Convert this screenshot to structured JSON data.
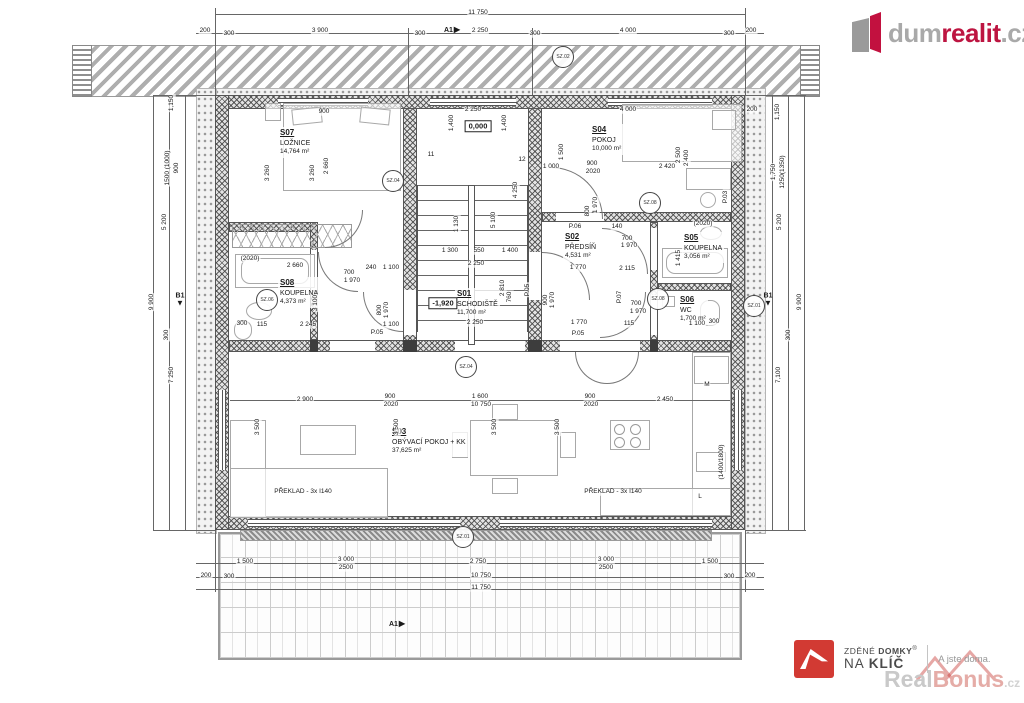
{
  "logo": {
    "gray": "dum",
    "red": "realit",
    "tld": ".cz"
  },
  "footer": {
    "brand_top": "ZDĚNÉ",
    "brand_top_b": "DOMKY",
    "reg": "®",
    "brand_bot": "NA",
    "brand_bot_b": "KLÍČ",
    "tagline": "A jste doma.",
    "wm_gray": "Real",
    "wm_red": "Bonus",
    "wm_tld": ".cz"
  },
  "rooms": {
    "s07": {
      "id": "S07",
      "name": "LOŽNICE",
      "area": "14,764 m²"
    },
    "s04": {
      "id": "S04",
      "name": "POKOJ",
      "area": "10,000 m²"
    },
    "s02": {
      "id": "S02",
      "name": "PŘEDSÍŇ",
      "area": "4,531 m²"
    },
    "s05": {
      "id": "S05",
      "name": "KOUPELNA",
      "area": "3,056 m²"
    },
    "s06": {
      "id": "S06",
      "name": "WC",
      "area": "1,700 m²"
    },
    "s08": {
      "id": "S08",
      "name": "KOUPELNA",
      "area": "4,373 m²"
    },
    "s01": {
      "id": "S01",
      "name": "SCHODIŠTĚ",
      "area": "11,700 m²"
    },
    "s03": {
      "id": "S03",
      "name": "OBÝVACÍ POKOJ + KK",
      "area": "37,625 m²"
    }
  },
  "circle_markers": [
    {
      "label": "SZ.02",
      "x": 563,
      "y": 57
    },
    {
      "label": "SZ.04",
      "x": 393,
      "y": 181
    },
    {
      "label": "SZ.08",
      "x": 650,
      "y": 203
    },
    {
      "label": "SZ.06",
      "x": 267,
      "y": 300
    },
    {
      "label": "SZ.08",
      "x": 658,
      "y": 299
    },
    {
      "label": "SZ.04",
      "x": 466,
      "y": 367
    },
    {
      "label": "SZ.01",
      "x": 463,
      "y": 537
    },
    {
      "label": "SZ.01",
      "x": 754,
      "y": 306
    }
  ],
  "flag_markers": [
    {
      "label": "A1",
      "x": 452,
      "y": 30,
      "dir": "right"
    },
    {
      "label": "A1",
      "x": 397,
      "y": 624,
      "dir": "right"
    },
    {
      "label": "B1",
      "x": 180,
      "y": 300,
      "dir": "down"
    },
    {
      "label": "B1",
      "x": 768,
      "y": 300,
      "dir": "down"
    }
  ],
  "annotations": [
    {
      "t": "11 750",
      "x": 478,
      "y": 13
    },
    {
      "t": "200",
      "x": 205,
      "y": 31
    },
    {
      "t": "300",
      "x": 229,
      "y": 34
    },
    {
      "t": "3 900",
      "x": 320,
      "y": 31
    },
    {
      "t": "300",
      "x": 420,
      "y": 34
    },
    {
      "t": "2 250",
      "x": 480,
      "y": 31
    },
    {
      "t": "300",
      "x": 535,
      "y": 34
    },
    {
      "t": "4 000",
      "x": 628,
      "y": 31
    },
    {
      "t": "300",
      "x": 729,
      "y": 34
    },
    {
      "t": "200",
      "x": 751,
      "y": 31
    },
    {
      "t": "1 500",
      "x": 245,
      "y": 562
    },
    {
      "t": "3 000",
      "x": 346,
      "y": 560
    },
    {
      "t": "2500",
      "x": 346,
      "y": 568
    },
    {
      "t": "2 750",
      "x": 478,
      "y": 562
    },
    {
      "t": "3 000",
      "x": 606,
      "y": 560
    },
    {
      "t": "2500",
      "x": 606,
      "y": 568
    },
    {
      "t": "1 500",
      "x": 710,
      "y": 562
    },
    {
      "t": "200",
      "x": 206,
      "y": 576
    },
    {
      "t": "300",
      "x": 229,
      "y": 577
    },
    {
      "t": "300",
      "x": 729,
      "y": 577
    },
    {
      "t": "200",
      "x": 750,
      "y": 576
    },
    {
      "t": "10 750",
      "x": 481,
      "y": 576
    },
    {
      "t": "11 750",
      "x": 481,
      "y": 588
    },
    {
      "t": "1,150",
      "x": 172,
      "y": 103,
      "r": 1
    },
    {
      "t": "1500 (1000)",
      "x": 168,
      "y": 168,
      "r": 1
    },
    {
      "t": "900",
      "x": 177,
      "y": 168,
      "r": 1
    },
    {
      "t": "5 200",
      "x": 165,
      "y": 222,
      "r": 1
    },
    {
      "t": "9 900",
      "x": 152,
      "y": 302,
      "r": 1
    },
    {
      "t": "300",
      "x": 167,
      "y": 335,
      "r": 1
    },
    {
      "t": "7 250",
      "x": 172,
      "y": 375,
      "r": 1
    },
    {
      "t": "200",
      "x": 752,
      "y": 110
    },
    {
      "t": "1,150",
      "x": 778,
      "y": 112,
      "r": 1
    },
    {
      "t": "1,750",
      "x": 774,
      "y": 172,
      "r": 1
    },
    {
      "t": "1250(1350)",
      "x": 783,
      "y": 172,
      "r": 1
    },
    {
      "t": "5 200",
      "x": 780,
      "y": 222,
      "r": 1
    },
    {
      "t": "9 900",
      "x": 800,
      "y": 302,
      "r": 1
    },
    {
      "t": "300",
      "x": 789,
      "y": 335,
      "r": 1
    },
    {
      "t": "7,100",
      "x": 779,
      "y": 375,
      "r": 1
    },
    {
      "t": "900",
      "x": 324,
      "y": 112
    },
    {
      "t": "2 250",
      "x": 473,
      "y": 110
    },
    {
      "t": "1,400",
      "x": 452,
      "y": 123,
      "r": 1
    },
    {
      "t": "1,400",
      "x": 505,
      "y": 123,
      "r": 1
    },
    {
      "t": "4 000",
      "x": 628,
      "y": 110
    },
    {
      "t": "3 260",
      "x": 268,
      "y": 173,
      "r": 1
    },
    {
      "t": "3 260",
      "x": 313,
      "y": 173,
      "r": 1
    },
    {
      "t": "2 660",
      "x": 327,
      "y": 166,
      "r": 1
    },
    {
      "t": "1 500",
      "x": 562,
      "y": 152,
      "r": 1
    },
    {
      "t": "2 500",
      "x": 679,
      "y": 155,
      "r": 1
    },
    {
      "t": "2 400",
      "x": 687,
      "y": 158,
      "r": 1
    },
    {
      "t": "1 000",
      "x": 551,
      "y": 167
    },
    {
      "t": "900",
      "x": 592,
      "y": 164
    },
    {
      "t": "2020",
      "x": 593,
      "y": 172
    },
    {
      "t": "2 420",
      "x": 667,
      "y": 167
    },
    {
      "t": "1 970",
      "x": 596,
      "y": 205,
      "r": 1
    },
    {
      "t": "800",
      "x": 588,
      "y": 211,
      "r": 1
    },
    {
      "t": "P.06",
      "x": 575,
      "y": 227
    },
    {
      "t": "140",
      "x": 617,
      "y": 227
    },
    {
      "t": "P.03",
      "x": 726,
      "y": 197,
      "r": 1
    },
    {
      "t": "700",
      "x": 627,
      "y": 239
    },
    {
      "t": "1 970",
      "x": 629,
      "y": 246
    },
    {
      "t": "(2020)",
      "x": 703,
      "y": 224
    },
    {
      "t": "1 770",
      "x": 578,
      "y": 268
    },
    {
      "t": "2 115",
      "x": 627,
      "y": 269
    },
    {
      "t": "1 415",
      "x": 679,
      "y": 258,
      "r": 1
    },
    {
      "t": "900",
      "x": 546,
      "y": 300,
      "r": 1
    },
    {
      "t": "1 970",
      "x": 553,
      "y": 300,
      "r": 1
    },
    {
      "t": "1 770",
      "x": 579,
      "y": 323
    },
    {
      "t": "P.05",
      "x": 578,
      "y": 334
    },
    {
      "t": "P.07",
      "x": 620,
      "y": 297,
      "r": 1
    },
    {
      "t": "700",
      "x": 636,
      "y": 304
    },
    {
      "t": "1 970",
      "x": 638,
      "y": 312
    },
    {
      "t": "115",
      "x": 629,
      "y": 324
    },
    {
      "t": "1 100",
      "x": 697,
      "y": 324
    },
    {
      "t": "300",
      "x": 714,
      "y": 322
    },
    {
      "t": "(2020)",
      "x": 250,
      "y": 259
    },
    {
      "t": "2 660",
      "x": 295,
      "y": 266
    },
    {
      "t": "700",
      "x": 349,
      "y": 273
    },
    {
      "t": "1 970",
      "x": 352,
      "y": 281
    },
    {
      "t": "240",
      "x": 371,
      "y": 268
    },
    {
      "t": "1 100",
      "x": 391,
      "y": 268
    },
    {
      "t": "3 100",
      "x": 316,
      "y": 303,
      "r": 1
    },
    {
      "t": "2 245",
      "x": 308,
      "y": 325
    },
    {
      "t": "115",
      "x": 262,
      "y": 325
    },
    {
      "t": "300",
      "x": 242,
      "y": 324
    },
    {
      "t": "800",
      "x": 380,
      "y": 310,
      "r": 1
    },
    {
      "t": "1 970",
      "x": 387,
      "y": 310,
      "r": 1
    },
    {
      "t": "1 100",
      "x": 391,
      "y": 325
    },
    {
      "t": "P.05",
      "x": 377,
      "y": 333
    },
    {
      "t": "11",
      "x": 431,
      "y": 155
    },
    {
      "t": "12",
      "x": 522,
      "y": 160
    },
    {
      "t": "4 250",
      "x": 516,
      "y": 190,
      "r": 1
    },
    {
      "t": "5 100",
      "x": 494,
      "y": 220,
      "r": 1
    },
    {
      "t": "1 130",
      "x": 457,
      "y": 224,
      "r": 1
    },
    {
      "t": "2 810",
      "x": 503,
      "y": 288,
      "r": 1
    },
    {
      "t": "760",
      "x": 510,
      "y": 297,
      "r": 1
    },
    {
      "t": "P.05",
      "x": 528,
      "y": 290,
      "r": 1
    },
    {
      "t": "1 300",
      "x": 450,
      "y": 251
    },
    {
      "t": "550",
      "x": 479,
      "y": 251
    },
    {
      "t": "1 400",
      "x": 510,
      "y": 251
    },
    {
      "t": "2 250",
      "x": 476,
      "y": 264
    },
    {
      "t": "2 250",
      "x": 475,
      "y": 323
    },
    {
      "t": "2 900",
      "x": 305,
      "y": 400
    },
    {
      "t": "900",
      "x": 390,
      "y": 397
    },
    {
      "t": "2020",
      "x": 391,
      "y": 405
    },
    {
      "t": "1 600",
      "x": 480,
      "y": 397
    },
    {
      "t": "10 750",
      "x": 481,
      "y": 405
    },
    {
      "t": "900",
      "x": 590,
      "y": 397
    },
    {
      "t": "2020",
      "x": 591,
      "y": 405
    },
    {
      "t": "2 450",
      "x": 665,
      "y": 400
    },
    {
      "t": "3 500",
      "x": 258,
      "y": 427,
      "r": 1
    },
    {
      "t": "3 500",
      "x": 397,
      "y": 427,
      "r": 1
    },
    {
      "t": "3 500",
      "x": 495,
      "y": 427,
      "r": 1
    },
    {
      "t": "3 500",
      "x": 558,
      "y": 427,
      "r": 1
    },
    {
      "t": "M",
      "x": 707,
      "y": 385
    },
    {
      "t": "L",
      "x": 700,
      "y": 497
    },
    {
      "t": "(1400/1800)",
      "x": 722,
      "y": 462,
      "r": 1
    },
    {
      "t": "PŘEKLAD - 3x I140",
      "x": 303,
      "y": 492
    },
    {
      "t": "PŘEKLAD - 3x I140",
      "x": 613,
      "y": 492
    },
    {
      "t": "0,000",
      "x": 478,
      "y": 126,
      "b": 1
    },
    {
      "t": "-1,920",
      "x": 443,
      "y": 303,
      "b": 1
    }
  ]
}
